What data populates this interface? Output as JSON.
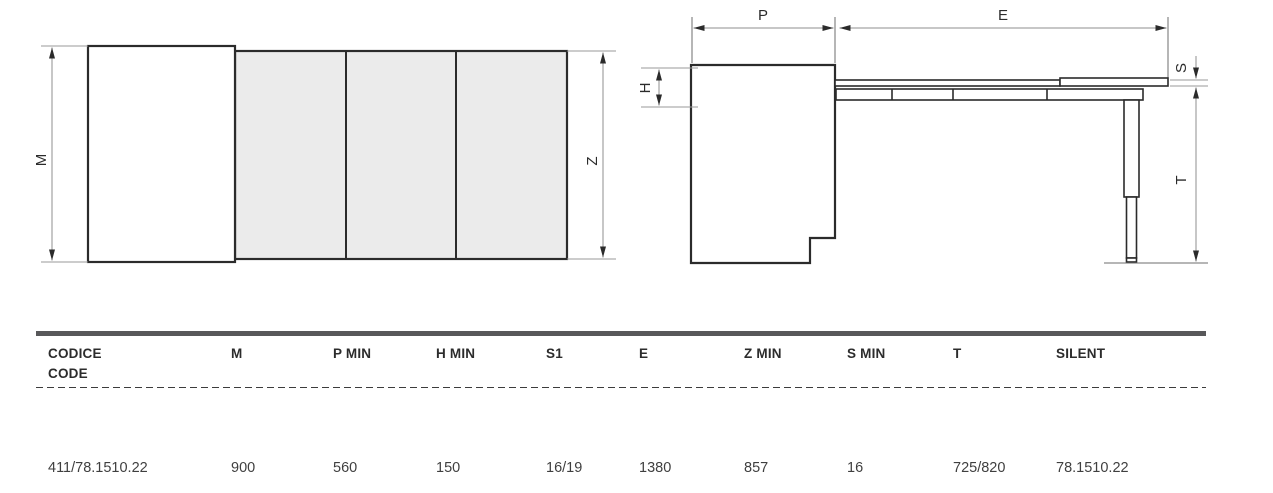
{
  "diagram": {
    "plan_view": {
      "labels": {
        "m": "M",
        "z": "Z"
      }
    },
    "side_view": {
      "labels": {
        "p": "P",
        "e": "E",
        "h": "H",
        "s": "S",
        "t": "T"
      }
    }
  },
  "table": {
    "header": {
      "codice": "CODICE",
      "code": "CODE",
      "m": "M",
      "p_min": "P MIN",
      "h_min": "H MIN",
      "s1": "S1",
      "e": "E",
      "z_min": "Z MIN",
      "s_min": "S MIN",
      "t": "T",
      "silent": "SILENT"
    },
    "row": {
      "codice_code": "411/78.1510.22",
      "m": "900",
      "p_min": "560",
      "h_min": "150",
      "s1": "16/19",
      "e": "1380",
      "z_min": "857",
      "s_min": "16",
      "t": "725/820",
      "silent": "78.1510.22"
    }
  },
  "colors": {
    "outline_dark": "#2b2b2b",
    "dimension_line": "#8f8f8f",
    "panel_fill": "#ebebeb",
    "header_bar": "#58585a",
    "header_text": "#2c2c2c",
    "row_text": "#3f3f3f"
  }
}
